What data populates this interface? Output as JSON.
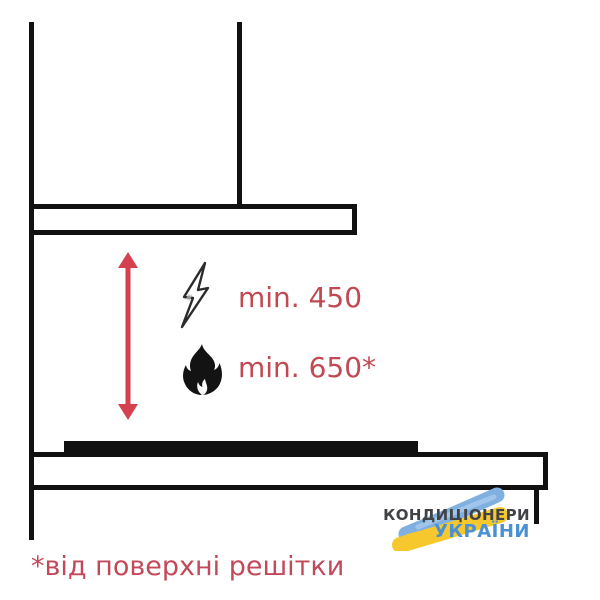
{
  "diagram": {
    "title_semantic": "cooker hood installation clearance diagram",
    "clearances": [
      {
        "type": "electric-hob",
        "icon": "lightning-icon",
        "label": "min. 450"
      },
      {
        "type": "gas-hob",
        "icon": "flame-icon",
        "label": "min. 650*"
      }
    ],
    "footnote": "*від поверхні решітки"
  },
  "logo": {
    "line1": "КОНДИЦІОНЕРИ",
    "line2": "УКРАЇНИ"
  },
  "colors": {
    "line_black": "#111111",
    "arrow_red": "#d4414e",
    "label_red": "#c24953",
    "footnote_red": "#c2495a",
    "logo_text_gray": "#414246",
    "logo_text_blue": "#4a90d5",
    "brush_blue": "#7fb0e0",
    "brush_yellow": "#f6c82d"
  }
}
